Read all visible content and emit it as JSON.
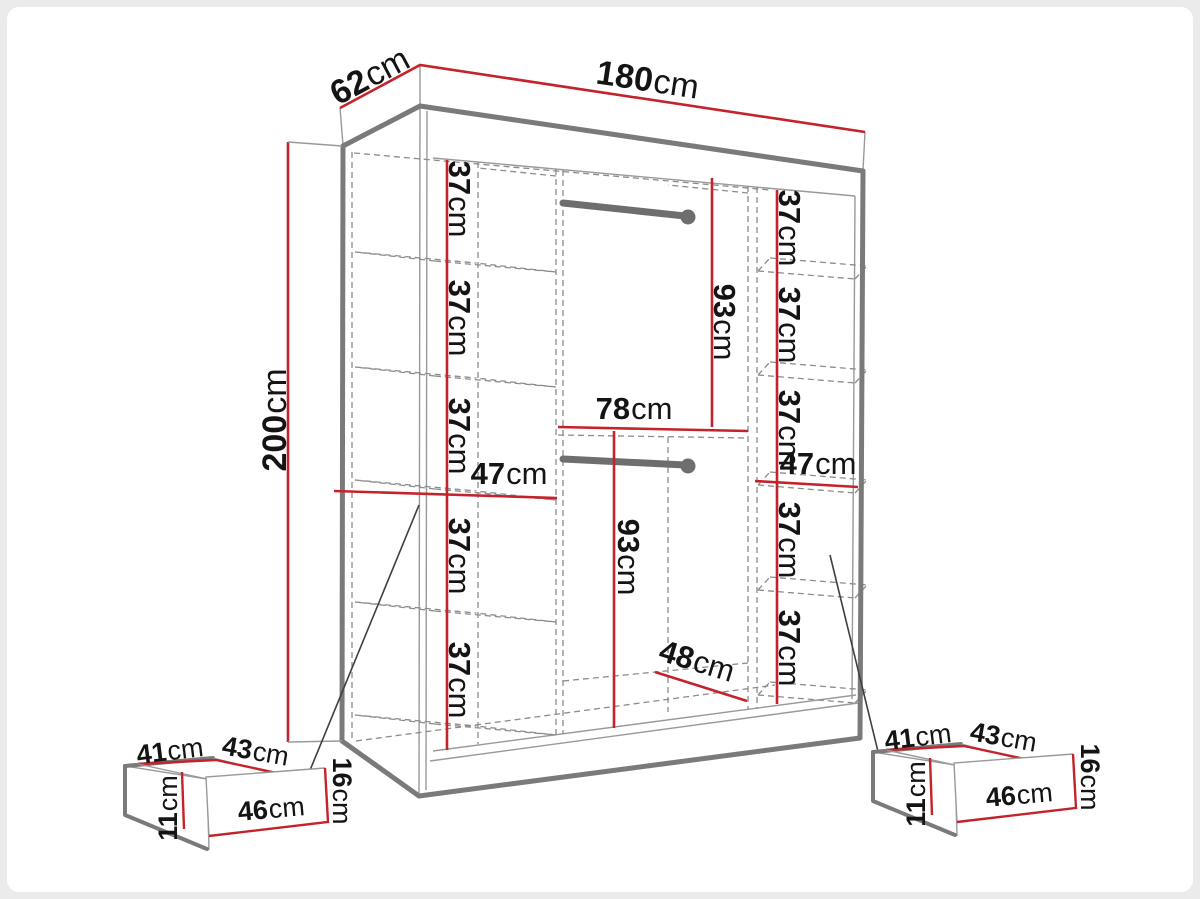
{
  "unit": "cm",
  "wardrobe": {
    "width": "180",
    "depth": "62",
    "height": "200"
  },
  "left_column": {
    "shelf_heights": [
      "37",
      "37",
      "37",
      "37",
      "37"
    ],
    "section_width": "47"
  },
  "middle_column": {
    "upper_rod_height": "93",
    "upper_section_width": "78",
    "lower_rod_height": "93",
    "lower_section_depth": "48"
  },
  "right_column": {
    "shelf_heights": [
      "37",
      "37",
      "37",
      "37",
      "37"
    ],
    "section_width": "47"
  },
  "drawer": {
    "back_width": "41",
    "top_depth": "43",
    "front_width": "46",
    "front_height": "16",
    "side_height": "11"
  },
  "colors": {
    "dimension_red": "#c5232b",
    "outline_gray": "#7a7a7a"
  }
}
